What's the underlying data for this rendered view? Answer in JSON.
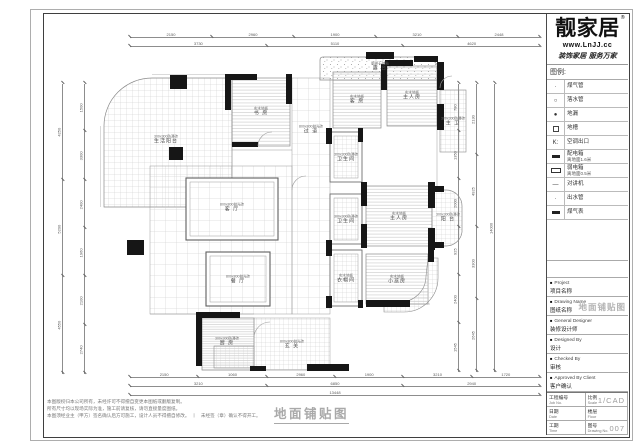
{
  "sheet": {
    "drawing_title": "地面铺贴图",
    "notes": [
      "本图版权归本公司所有，未经许可不得擅自变更本图纸或翻版复制。",
      "所有尺寸均以现场实际为准，施工前请复核，请勿直接量度图纸。",
      "本图须经业主（甲方）签名确认后方可施工，设计人员不得擅自修改。　丨　未经签（章）确认不得开工。"
    ]
  },
  "titleblock": {
    "brand": "靓家居",
    "brand_reg": "®",
    "website": "www.LnJJ.cc",
    "slogan": "装饰家居 服务万家",
    "legend_header": "图例:",
    "legend": [
      {
        "symbol": "dot-small",
        "label": "煤气管"
      },
      {
        "symbol": "circle",
        "label": "落水管"
      },
      {
        "symbol": "dot",
        "label": "地漏"
      },
      {
        "symbol": "square",
        "label": "地槽"
      },
      {
        "symbol": "text-k",
        "symbol_text": "K:",
        "label": "空调出口"
      },
      {
        "symbol": "bar-filled",
        "label": "配电箱",
        "sub": "离地面1.6米"
      },
      {
        "symbol": "bar-open",
        "label": "弱电箱",
        "sub": "离地面0.5米"
      },
      {
        "symbol": "dash",
        "label": "对讲机"
      },
      {
        "symbol": "dot-small",
        "label": "出水管"
      },
      {
        "symbol": "bar-filled",
        "label": "煤气表"
      }
    ],
    "fields": [
      {
        "en": "Project",
        "cn": "项目名称"
      },
      {
        "en": "Drawing Name",
        "cn": "图纸名称",
        "stamp": "地面铺贴图"
      },
      {
        "en": "General Designer",
        "cn": "装修设计师"
      },
      {
        "en": "Designed By",
        "cn": "设计"
      },
      {
        "en": "Checked By",
        "cn": "审核"
      },
      {
        "en": "Approved By Client",
        "cn": "客户确认"
      }
    ],
    "table": [
      [
        {
          "cn": "工程编号",
          "en": "Job No."
        },
        {
          "cn": "比例",
          "en": "Scale",
          "value": "1/CAD"
        }
      ],
      [
        {
          "cn": "日期",
          "en": "Date"
        },
        {
          "cn": "楼层",
          "en": "Floor",
          "value": ""
        }
      ],
      [
        {
          "cn": "工期",
          "en": "Time"
        },
        {
          "cn": "图号",
          "en": "Drawing No.",
          "value": "007"
        }
      ]
    ]
  },
  "plan": {
    "rooms": [
      {
        "name": "生活阳台",
        "spec": "300x300防滑砖",
        "x": 166,
        "y": 140
      },
      {
        "name": "书 房",
        "spec": "实木地板",
        "x": 261,
        "y": 112
      },
      {
        "name": "过 道",
        "spec": "800x800抛光砖",
        "x": 311,
        "y": 130
      },
      {
        "name": "露 台",
        "spec": "鹅卵石铺贴",
        "x": 380,
        "y": 67
      },
      {
        "name": "客 房",
        "spec": "实木地板",
        "x": 357,
        "y": 100
      },
      {
        "name": "主人房",
        "spec": "实木地板",
        "x": 412,
        "y": 96
      },
      {
        "name": "主 卫",
        "spec": "300x300防滑砖",
        "x": 453,
        "y": 122
      },
      {
        "name": "客 厅",
        "spec": "800x800抛光砖",
        "x": 232,
        "y": 208
      },
      {
        "name": "餐 厅",
        "spec": "800x800抛光砖",
        "x": 238,
        "y": 280
      },
      {
        "name": "卫生间",
        "spec": "300x300防滑砖",
        "x": 346,
        "y": 158
      },
      {
        "name": "卫生间",
        "spec": "300x300防滑砖",
        "x": 346,
        "y": 220
      },
      {
        "name": "衣帽间",
        "spec": "实木地板",
        "x": 346,
        "y": 279
      },
      {
        "name": "主人房",
        "spec": "实木地板",
        "x": 399,
        "y": 217
      },
      {
        "name": "阳 台",
        "spec": "300x300防滑砖",
        "x": 448,
        "y": 218
      },
      {
        "name": "小孩房",
        "spec": "实木地板",
        "x": 397,
        "y": 280
      },
      {
        "name": "厨 房",
        "spec": "300x300防滑砖",
        "x": 227,
        "y": 342
      },
      {
        "name": "玄 关",
        "spec": "800x800抛光砖",
        "x": 292,
        "y": 345
      }
    ],
    "dimension_chains": [
      {
        "dir": "h",
        "x": 130,
        "y": 37,
        "len": 410,
        "values": [
          "2150",
          "2960",
          "1900",
          "3210",
          "2448"
        ]
      },
      {
        "dir": "h",
        "x": 130,
        "y": 46,
        "len": 410,
        "values": [
          "3730",
          "5110",
          "4620"
        ]
      },
      {
        "dir": "v",
        "x": 62,
        "y": 84,
        "len": 290,
        "values": [
          "4250",
          "5200",
          "4550"
        ]
      },
      {
        "dir": "v",
        "x": 84,
        "y": 84,
        "len": 290,
        "values": [
          "1500",
          "3300",
          "2400",
          "1960",
          "2100",
          "2740"
        ]
      },
      {
        "dir": "v",
        "x": 458,
        "y": 84,
        "len": 288,
        "values": [
          "780",
          "1350",
          "2000",
          "925",
          "2400",
          "1545"
        ]
      },
      {
        "dir": "v",
        "x": 476,
        "y": 84,
        "len": 288,
        "values": [
          "2130",
          "4925",
          "3300",
          "2645"
        ]
      },
      {
        "dir": "v",
        "x": 494,
        "y": 84,
        "len": 288,
        "values": [
          "14000"
        ]
      },
      {
        "dir": "h",
        "x": 130,
        "y": 377,
        "len": 410,
        "values": [
          "2150",
          "1060",
          "2960",
          "1900",
          "3210",
          "1720"
        ]
      },
      {
        "dir": "h",
        "x": 130,
        "y": 386,
        "len": 410,
        "values": [
          "3210",
          "6850",
          "2940"
        ]
      },
      {
        "dir": "h",
        "x": 130,
        "y": 395,
        "len": 410,
        "values": [
          "13448"
        ]
      }
    ]
  }
}
